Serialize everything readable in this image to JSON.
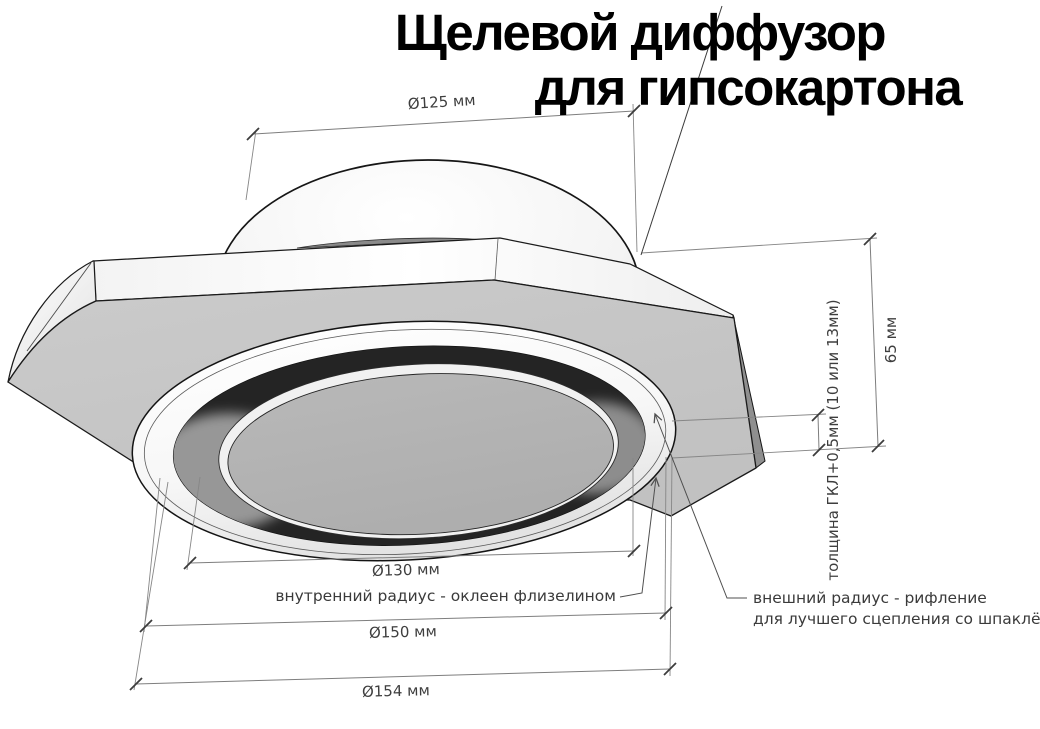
{
  "title": {
    "line1": "Щелевой диффузор",
    "line2": "для гипсокартона"
  },
  "dimensions": {
    "duct_diameter": {
      "label": "Ø125 мм"
    },
    "overall_height": {
      "label": "65 мм"
    },
    "panel_thickness": {
      "label": "толщина ГКЛ+0,5мм (10 или 13мм)"
    },
    "inner_diameter": {
      "label": "Ø130 мм"
    },
    "recess_diameter": {
      "label": "Ø150 мм"
    },
    "outer_diameter": {
      "label": "Ø154 мм"
    }
  },
  "callouts": {
    "inner_radius": {
      "label": "внутренний радиус - оклеен флизелином"
    },
    "outer_radius": {
      "line1": "внешний радиус - рифление",
      "line2": "для лучшего сцепления со шпаклёвкой"
    }
  },
  "colors": {
    "background": "#ffffff",
    "panel_gray": "#c6c6c6",
    "panel_top_gray": "#8a8a8a",
    "slot_dark": "#242424",
    "disc_gray": "#b4b4b4",
    "dimension_line_gray": "#7e7e7e",
    "text_gray": "#3e3e3e",
    "title_black": "#000000"
  }
}
